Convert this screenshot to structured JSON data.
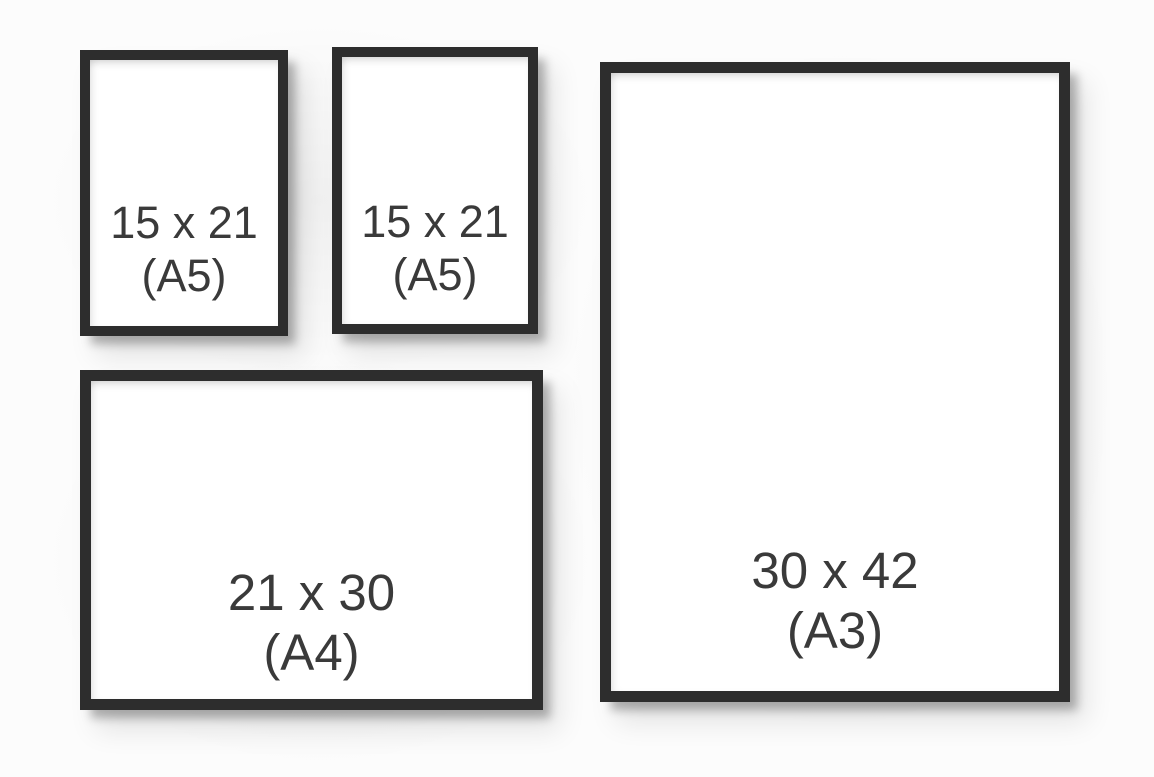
{
  "diagram": {
    "type": "frame-size-comparison"
  },
  "frames": [
    {
      "name": "a5-left",
      "size_label": "15 x 21",
      "format_label": "(A5)"
    },
    {
      "name": "a5-right",
      "size_label": "15 x 21",
      "format_label": "(A5)"
    },
    {
      "name": "a4",
      "size_label": "21 x 30",
      "format_label": "(A4)"
    },
    {
      "name": "a3",
      "size_label": "30 x 42",
      "format_label": "(A3)"
    }
  ],
  "colors": {
    "frame_border": "#2d2d2d",
    "frame_interior": "#ffffff",
    "label_text": "#3a3a3a",
    "background": "#fcfcfc",
    "shadow": "rgba(0,0,0,0.28)"
  }
}
